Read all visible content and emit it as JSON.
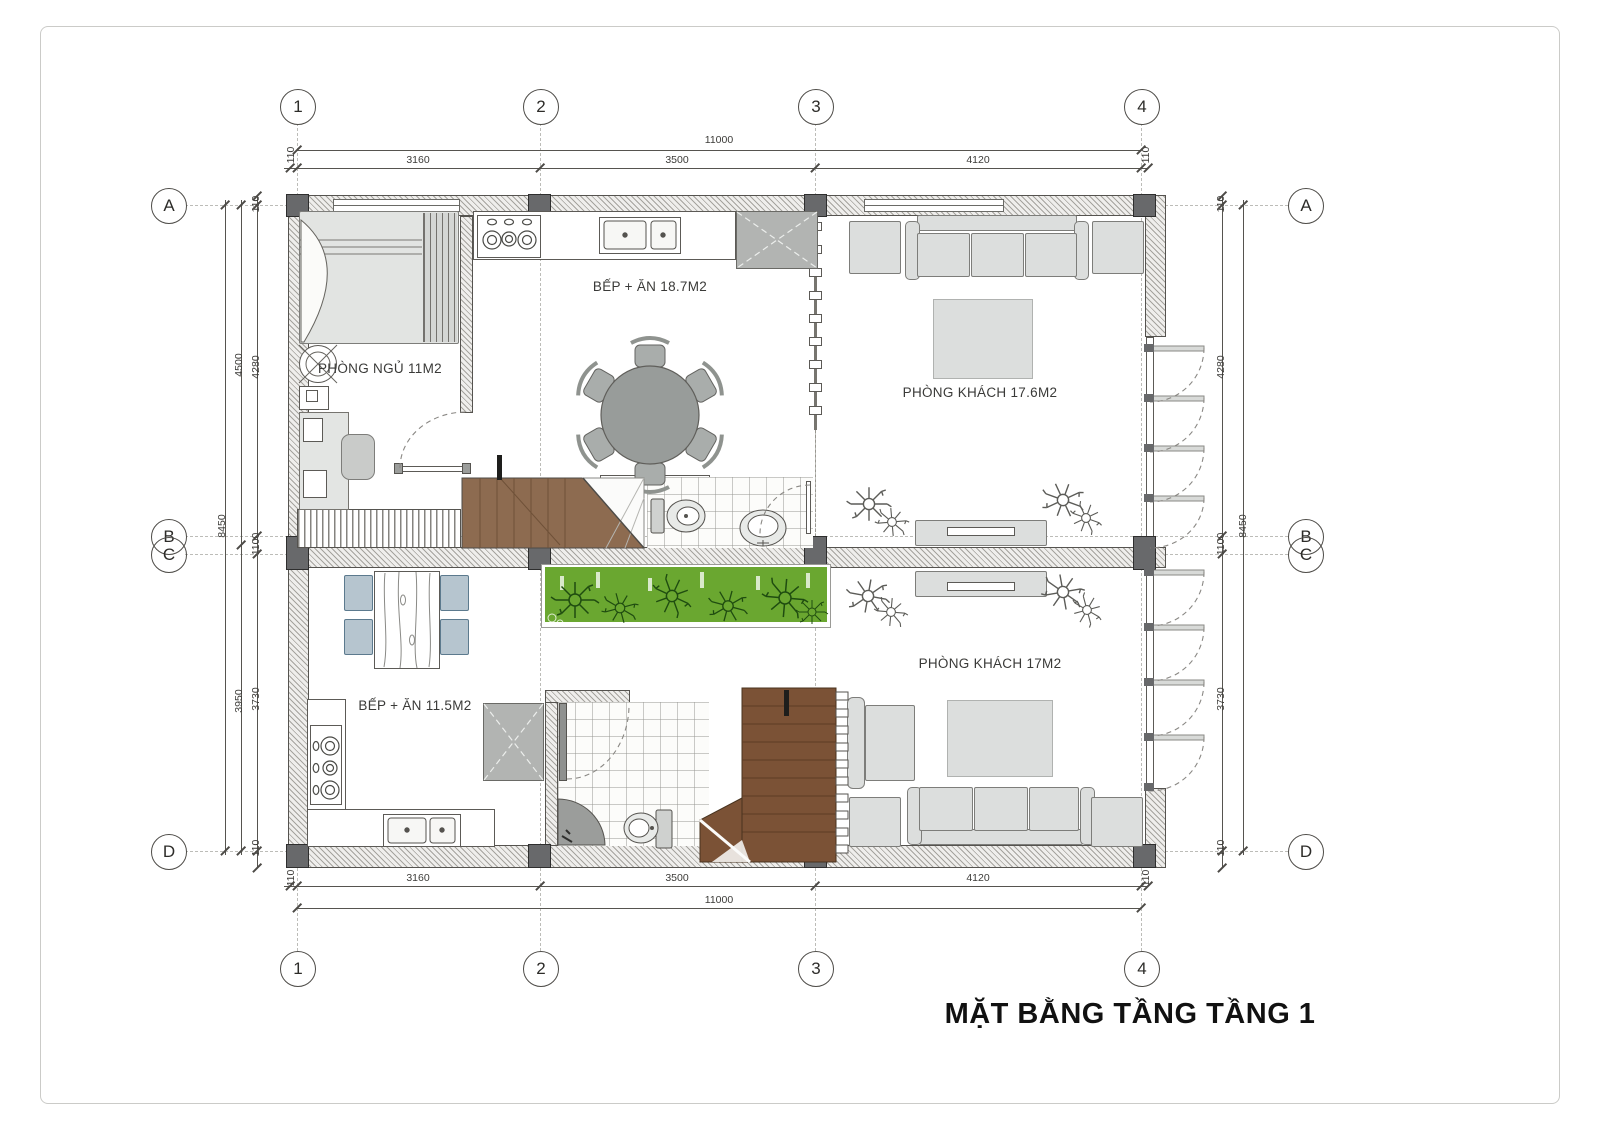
{
  "title": "MẶT BẰNG TẦNG TẦNG 1",
  "grid": {
    "cols": [
      "1",
      "2",
      "3",
      "4"
    ],
    "rows": [
      "A",
      "B",
      "C",
      "D"
    ]
  },
  "dims": {
    "top": {
      "overall": "11000",
      "s0": "110",
      "s1": "3160",
      "s2": "3500",
      "s3": "4120",
      "s4": "110"
    },
    "bottom": {
      "overall": "11000",
      "s0": "110",
      "s1": "3160",
      "s2": "3500",
      "s3": "4120",
      "s4": "110"
    },
    "left": {
      "overall": "8450",
      "sub0": "4500",
      "sub1": "3950",
      "s0": "110",
      "s1": "4280",
      "s2": "1100",
      "s3": "3730",
      "s4": "110"
    },
    "right": {
      "overall": "8450",
      "s0": "110",
      "s1": "4280",
      "s2": "1100",
      "s3": "3730",
      "s4": "110"
    }
  },
  "rooms": {
    "bedroom": "PHÒNG NGỦ 11M2",
    "kitchen1": "BẾP + ĂN 18.7M2",
    "living1": "PHÒNG KHÁCH 17.6M2",
    "kitchen2": "BẾP + ĂN 11.5M2",
    "living2": "PHÒNG KHÁCH 17M2"
  },
  "colors": {
    "stair_wood_light": "#8d6b50",
    "stair_wood_dark": "#7b5236",
    "garden_green": "#6aa730",
    "furniture_gray": "#dcdedd",
    "column_gray": "#68696b"
  }
}
